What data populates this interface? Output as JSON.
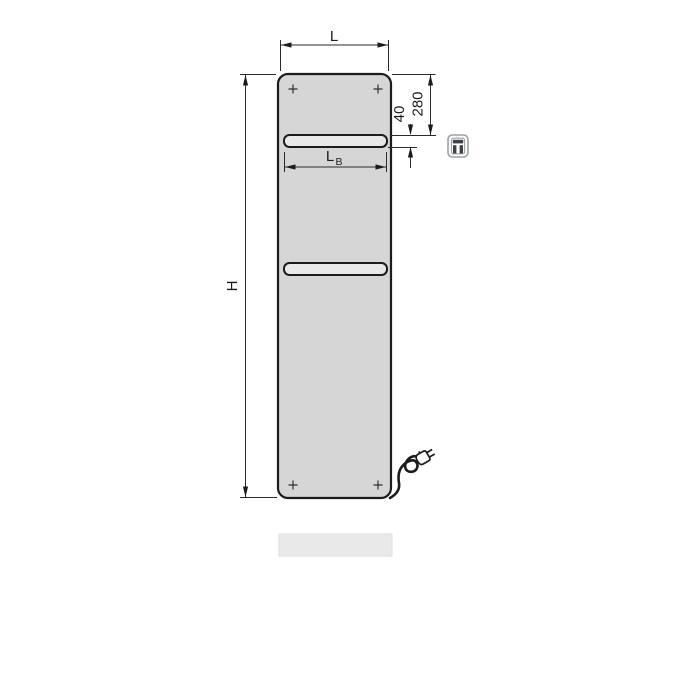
{
  "figure": {
    "title": "electric panel radiator dimensional drawing",
    "labels": {
      "width": "L",
      "height": "H",
      "bar_width_main": "L",
      "bar_width_sub": "B",
      "top_offset": "280",
      "bar_thickness": "40"
    },
    "icons": {
      "control_unit": "plug-in-control-unit-icon",
      "plug": "power-plug-icon",
      "mounting": "mounting-point-cross"
    },
    "colors": {
      "background": "#ffffff",
      "panel_fill": "#d6d6d6",
      "bar_fill": "#e9e9e9",
      "outline": "#1c1c1c",
      "dimension_line": "#2a2a2a",
      "icon_gray": "#9aa1a7",
      "icon_dark": "#3c4146",
      "shadow_strip": "#e9e9e9"
    }
  }
}
